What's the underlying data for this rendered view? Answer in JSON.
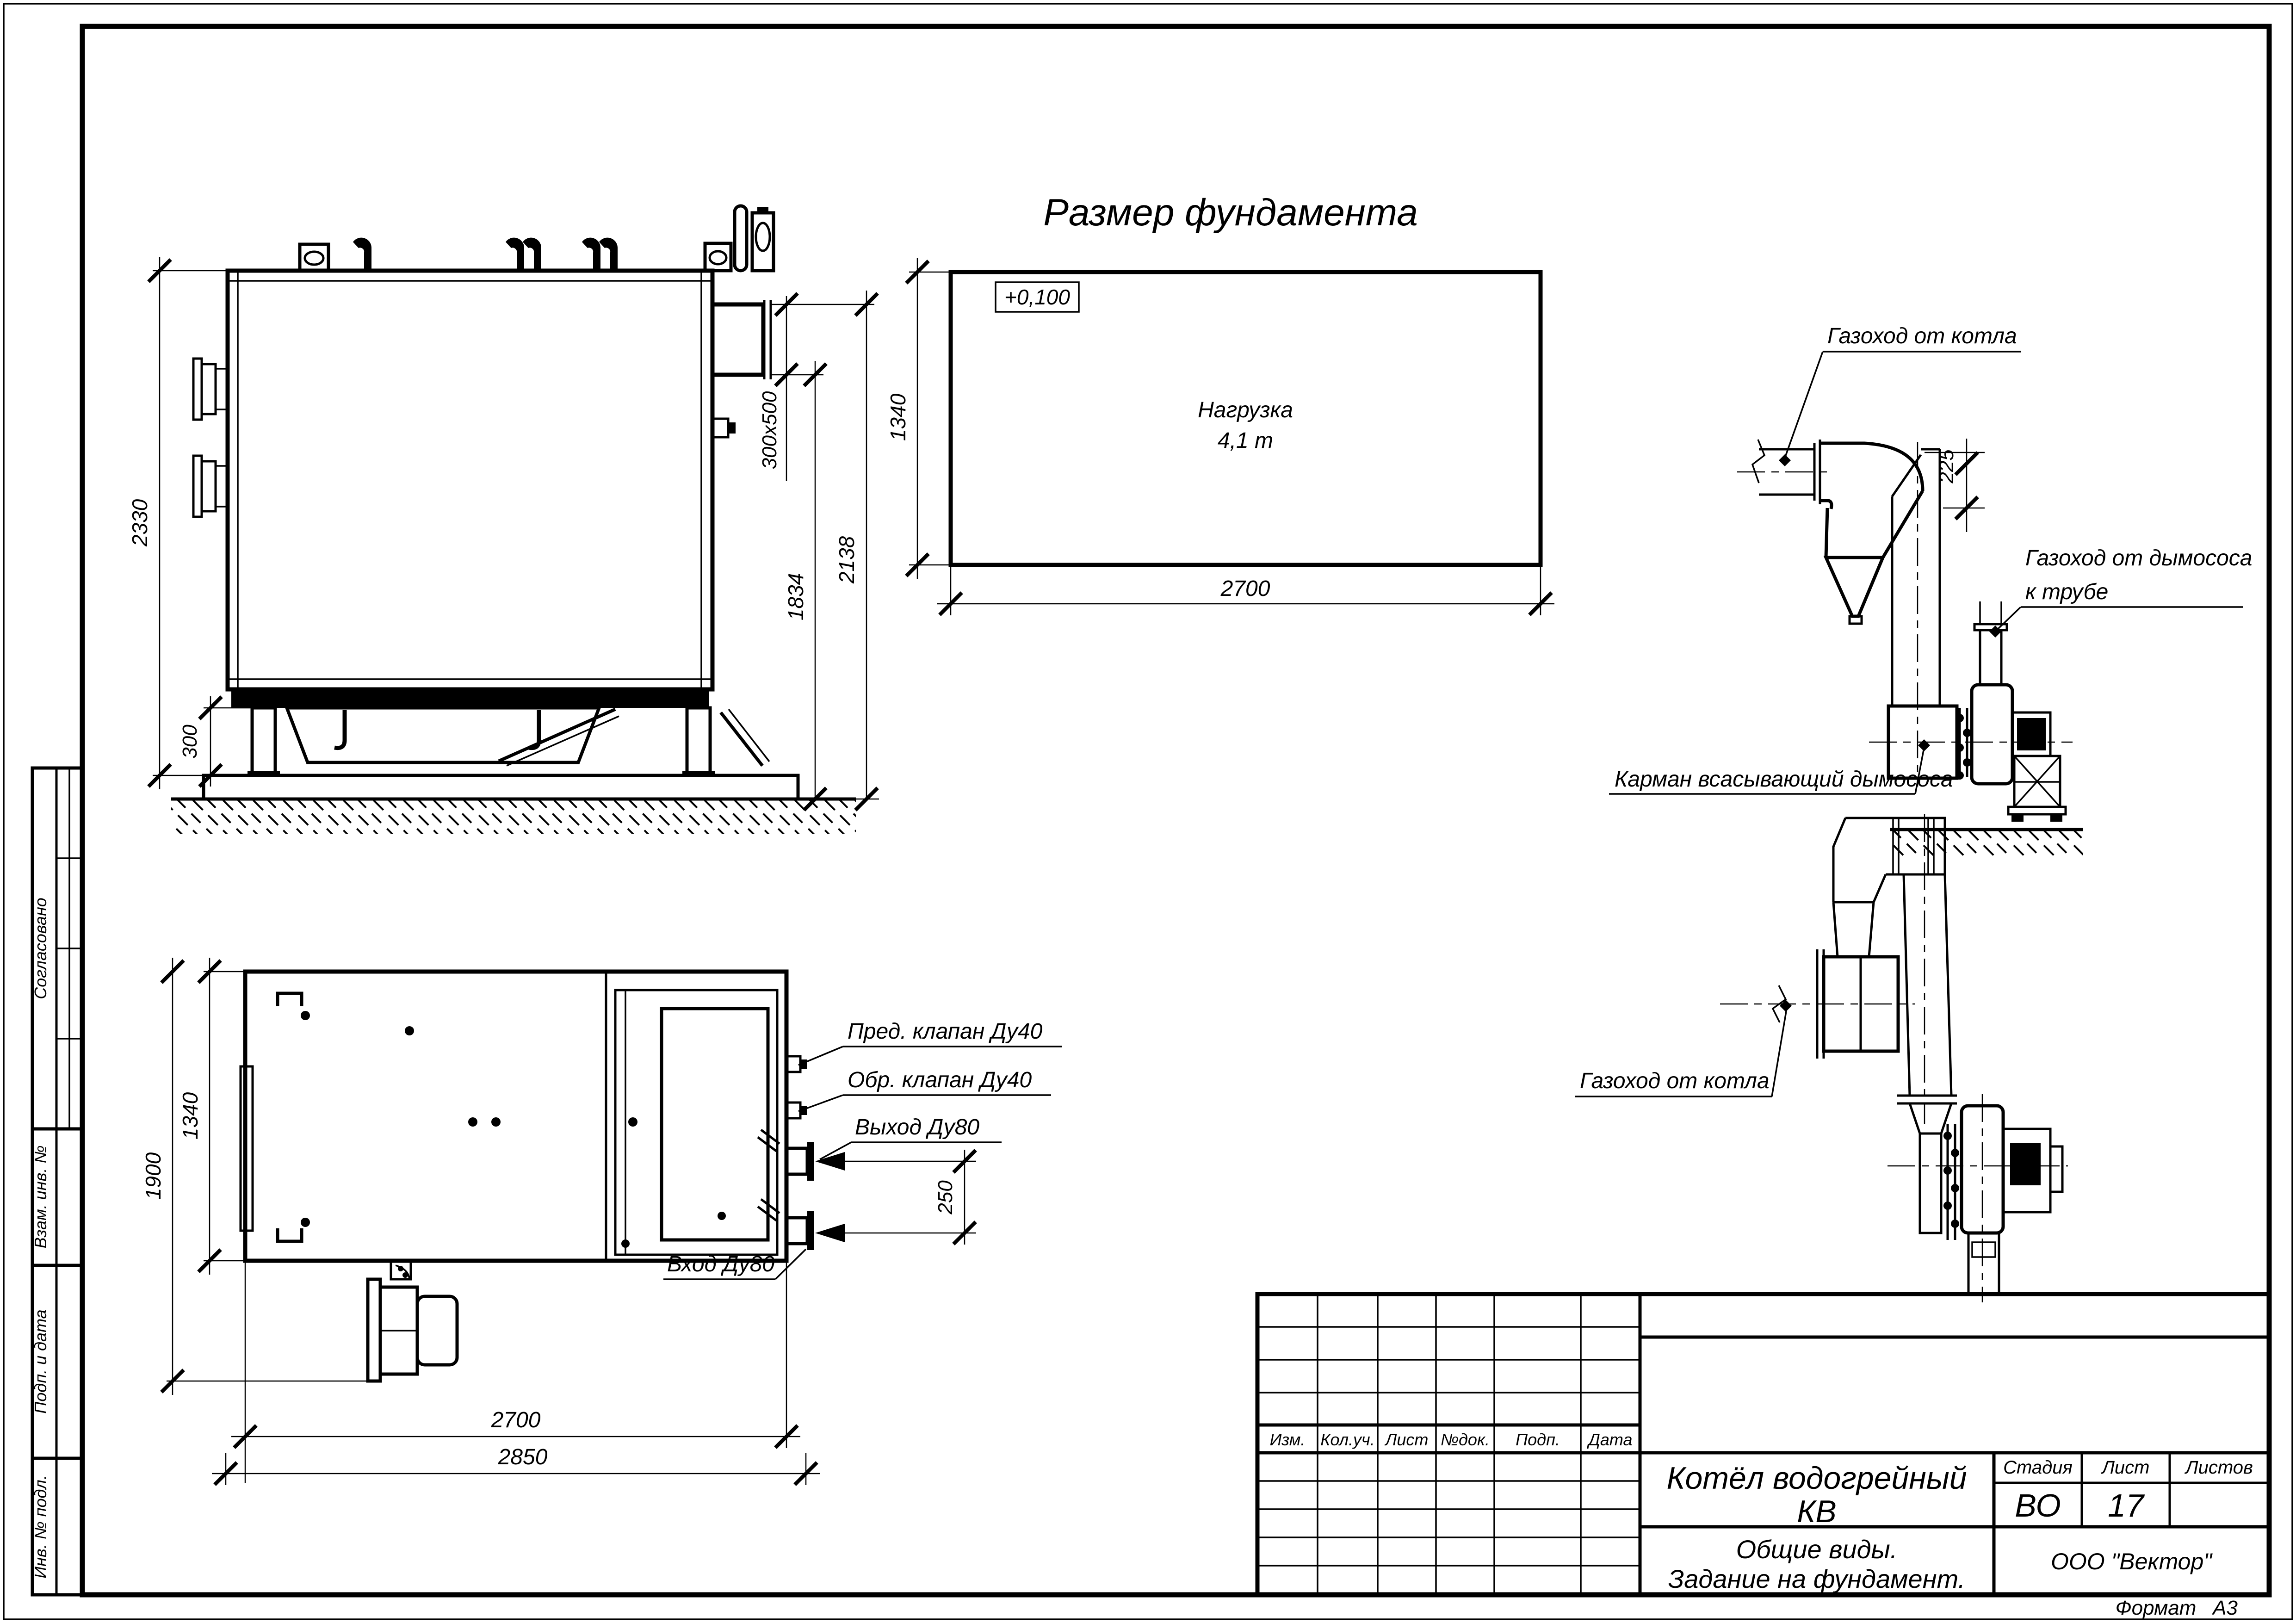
{
  "sheet": {
    "view_title": "Размер фундамента",
    "format_label": "Формат",
    "format_value": "А3"
  },
  "foundation_plan": {
    "elevation_mark": "+0,100",
    "load_line1": "Нагрузка",
    "load_line2": "4,1 т",
    "dim_length": "2700",
    "dim_width": "1340"
  },
  "side_view": {
    "dim_height": "2330",
    "dim_foundation": "300",
    "dim_duct_section": "300x500",
    "dim_duct_bottom": "1834",
    "dim_duct_top": "2138"
  },
  "plan_view": {
    "dim_width": "1340",
    "dim_width_overall": "1900",
    "dim_length": "2700",
    "dim_length_overall": "2850",
    "dim_nozzle_spacing": "250",
    "label_safety_valve": "Пред. клапан Ду40",
    "label_check_valve": "Обр. клапан Ду40",
    "label_outlet": "Выход Ду80",
    "label_inlet": "Вход Ду80"
  },
  "duct_side_detail": {
    "label_from_boiler": "Газоход от котла",
    "dim_offset": "225",
    "label_to_stack_line1": "Газоход от дымососа",
    "label_to_stack_line2": "к трубе",
    "label_pocket": "Карман всасывающий дымососа"
  },
  "duct_plan_detail": {
    "label_from_boiler": "Газоход от котла"
  },
  "title_block": {
    "columns": [
      "Изм.",
      "Кол.уч.",
      "Лист",
      "№док.",
      "Подп.",
      "Дата"
    ],
    "product_line1": "Котёл водогрейный",
    "product_line2": "КВ",
    "doc_line1": "Общие виды.",
    "doc_line2": "Задание на фундамент.",
    "stage_label": "Стадия",
    "sheet_label": "Лист",
    "sheets_label": "Листов",
    "stage": "ВО",
    "sheet_number": "17",
    "company": "ООО \"Вектор\""
  },
  "margin_stamps": {
    "agreed": "Согласовано",
    "replace_inv": "Взам. инв. №",
    "sign_date": "Подп. и дата",
    "inv_number": "Инв. № подл."
  }
}
